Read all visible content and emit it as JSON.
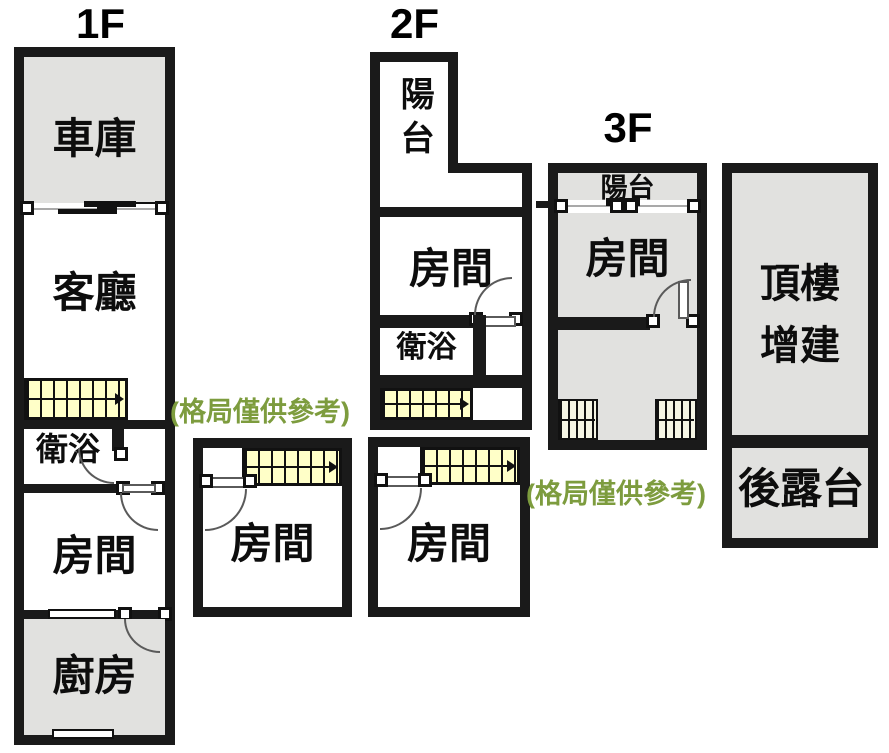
{
  "title": "房屋格局圖",
  "colors": {
    "wall": "#1a1a1a",
    "room_gray": "#e1e1df",
    "stair_fill": "#ffffc8",
    "note_green": "#7d9c3e",
    "background": "#ffffff"
  },
  "floor1": {
    "label": "1F",
    "garage": "車庫",
    "living_room": "客廳",
    "bathroom": "衛浴",
    "bedroom": "房間",
    "kitchen": "廚房",
    "rear_bedroom": "房間"
  },
  "floor2": {
    "label": "2F",
    "balcony": "陽台",
    "bedroom": "房間",
    "bathroom": "衛浴",
    "rear_bedroom": "房間"
  },
  "floor3": {
    "label": "3F",
    "balcony": "陽台",
    "bedroom": "房間"
  },
  "rooftop": {
    "addition_line1": "頂樓",
    "addition_line2": "增建",
    "rear_terrace": "後露台"
  },
  "notes": {
    "disclaimer1": "(格局僅供參考)",
    "disclaimer2": "(格局僅供參考)"
  }
}
